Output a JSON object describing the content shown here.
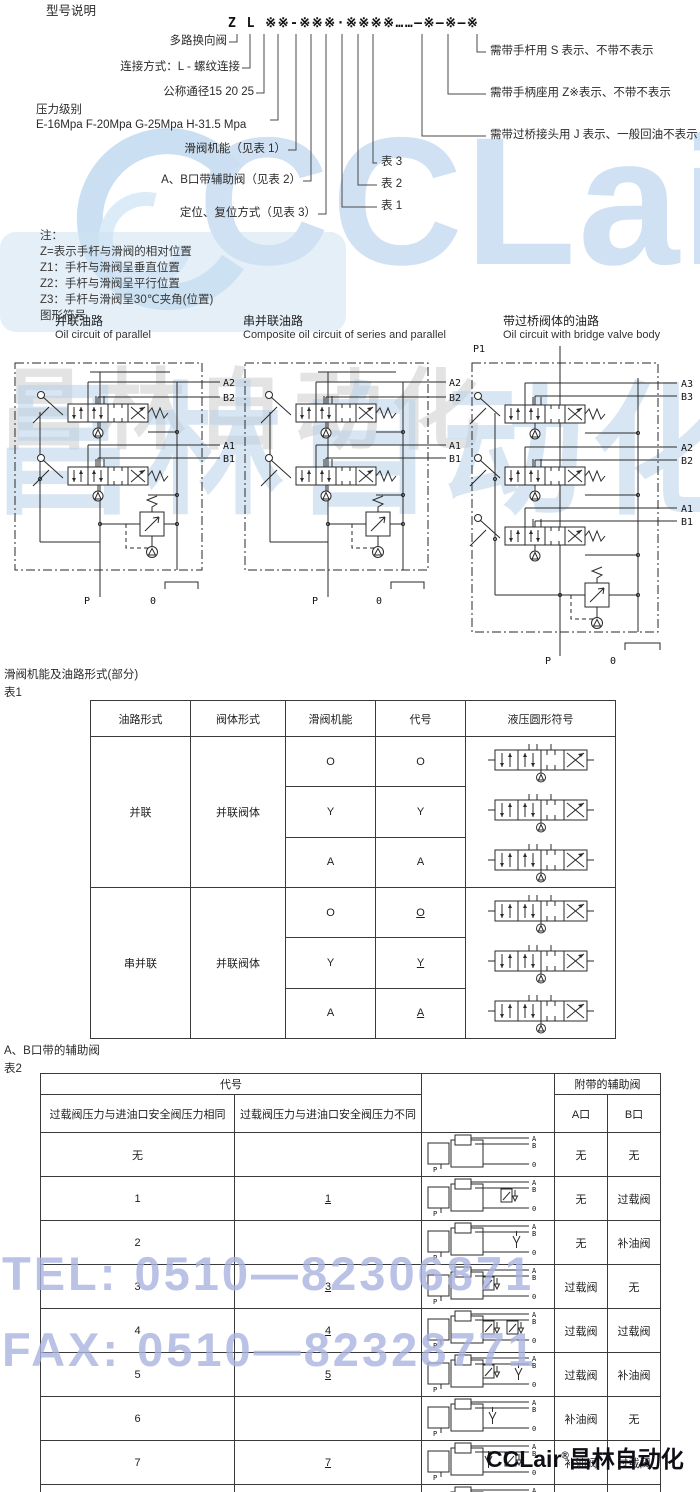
{
  "colors": {
    "line": "#3a3a3a",
    "watermark_blue": "#c3d8ee",
    "watermark_violet": "#a9b3e0",
    "text": "#222222"
  },
  "header": {
    "section_title": "型号说明",
    "model_code": "Z L ※※-※※※·※※※※……—※—※—※",
    "left_labels": [
      "多路换向阀",
      "连接方式：L - 螺纹连接",
      "公称通径15 20 25",
      "压力级别",
      "E-16Mpa F-20Mpa G-25Mpa H-31.5 Mpa",
      "滑阀机能（见表 1）",
      "A、B口带辅助阀（见表 2）",
      "定位、复位方式（见表 3）"
    ],
    "right_labels": [
      "需带手杆用 S 表示、不带不表示",
      "需带手柄座用 Z※表示、不带不表示",
      "需带过桥接头用 J 表示、一般回油不表示"
    ],
    "table_refs": [
      "表 3",
      "表 2",
      "表 1"
    ],
    "notes": [
      "注：",
      "Z=表示手杆与滑阀的相对位置",
      "Z1：手杆与滑阀呈垂直位置",
      "Z2：手杆与滑阀呈平行位置",
      "Z3：手杆与滑阀呈30℃夹角(位置)",
      "图形符号"
    ]
  },
  "circuits": [
    {
      "title_cn": "并联油路",
      "title_en": "Oil circuit of parallel",
      "ports": [
        "A2",
        "B2",
        "A1",
        "B1"
      ],
      "p": "P",
      "o": "0"
    },
    {
      "title_cn": "串并联油路",
      "title_en": "Composite oil circuit of series and parallel",
      "ports": [
        "A2",
        "B2",
        "A1",
        "B1"
      ],
      "p": "P",
      "o": "0"
    },
    {
      "title_cn": "带过桥阀体的油路",
      "title_en": "Oil circuit with bridge valve body",
      "p1": "P1",
      "ports": [
        "A3",
        "B3",
        "A2",
        "B2",
        "A1",
        "B1"
      ],
      "p": "P",
      "o": "0"
    }
  ],
  "table1": {
    "caption": "滑阀机能及油路形式(部分)",
    "label": "表1",
    "headers": [
      "油路形式",
      "阀体形式",
      "滑阀机能",
      "代号",
      "液压圆形符号"
    ],
    "groups": [
      {
        "circuit": "并联",
        "body": "并联阀体",
        "rows": [
          {
            "fn": "O",
            "code": "O"
          },
          {
            "fn": "Y",
            "code": "Y"
          },
          {
            "fn": "A",
            "code": "A"
          }
        ]
      },
      {
        "circuit": "串并联",
        "body": "并联阀体",
        "rows": [
          {
            "fn": "O",
            "code": "O"
          },
          {
            "fn": "Y",
            "code": "Y"
          },
          {
            "fn": "A",
            "code": "A"
          }
        ]
      }
    ]
  },
  "table2": {
    "caption": "A、B口带的辅助阀",
    "label": "表2",
    "header": {
      "code_group": "代号",
      "aux_group": "附带的辅助阀",
      "same": "过载阀压力与进油口安全阀压力相同",
      "diff": "过载阀压力与进油口安全阀压力不同",
      "a": "A口",
      "b": "B口"
    },
    "rows": [
      {
        "c1": "无",
        "c2": "",
        "a": "无",
        "b": "无"
      },
      {
        "c1": "1",
        "c2": "1",
        "a": "无",
        "b": "过载阀"
      },
      {
        "c1": "2",
        "c2": "",
        "a": "无",
        "b": "补油阀"
      },
      {
        "c1": "3",
        "c2": "3",
        "a": "过载阀",
        "b": "无"
      },
      {
        "c1": "4",
        "c2": "4",
        "a": "过载阀",
        "b": "过载阀"
      },
      {
        "c1": "5",
        "c2": "5",
        "a": "过载阀",
        "b": "补油阀"
      },
      {
        "c1": "6",
        "c2": "",
        "a": "补油阀",
        "b": "无"
      },
      {
        "c1": "7",
        "c2": "7",
        "a": "补油阀",
        "b": "过载阀"
      },
      {
        "c1": "8",
        "c2": "",
        "a": "补油阀",
        "b": "补油阀"
      }
    ]
  },
  "symbols": {
    "ports": {
      "a": "A",
      "b": "B",
      "o": "0",
      "p": "P"
    }
  },
  "watermarks": {
    "tel": "TEL: 0510—82306871",
    "fax": "FAX: 0510—82328771",
    "brand": "CCLair",
    "brand_cn": "昌林自动化",
    "footer_brand": "CCLair",
    "footer_reg": "®",
    "footer_cn": "昌林自动化"
  }
}
